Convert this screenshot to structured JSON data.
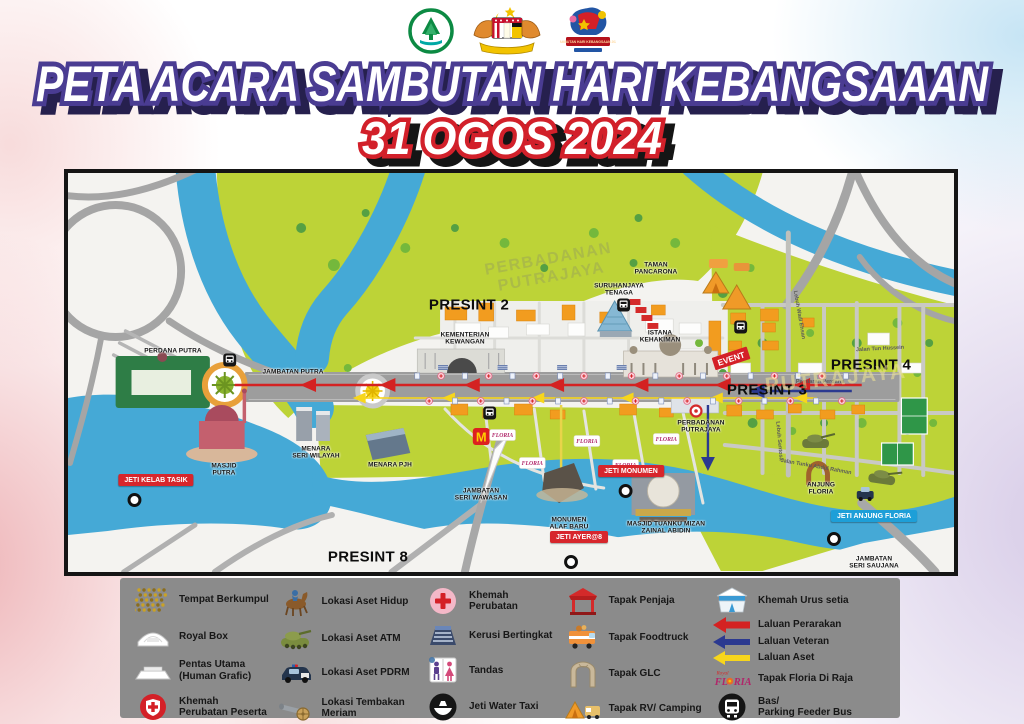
{
  "header": {
    "title": "PETA ACARA SAMBUTAN HARI KEBANGSAAAN",
    "date": "31 OGOS 2024",
    "logos": [
      {
        "name": "perbadanan-putrajaya-logo"
      },
      {
        "name": "jata-negara-malaysia-logo"
      },
      {
        "name": "sambutan-hari-kebangsaan-logo",
        "banner": "SAMBUTAN HARI KEBANGSAAN 2024"
      }
    ]
  },
  "colors": {
    "title_fill": "#ffffff",
    "title_stroke": "#4a3c92",
    "title_shadow": "#26204e",
    "date_stroke": "#d2202a",
    "date_shadow": "#151515",
    "map_green": "#bdd337",
    "map_water": "#45a9d6",
    "road_gray": "#a5a5a5",
    "legend_bg": "#8b8b8b",
    "route_parade": "#d42222",
    "route_veteran": "#2b3990",
    "route_asset": "#f7d61c",
    "badge_red": "#d7262c",
    "badge_blue": "#1d9fd8"
  },
  "map": {
    "event_flag": "EVENT",
    "floria_tag": "FLORIA",
    "mcdonalds": "M",
    "labels": [
      {
        "type": "presint",
        "text": "PRESINT 2",
        "x": 401,
        "y": 132
      },
      {
        "type": "presint",
        "text": "PRESINT 3",
        "x": 699,
        "y": 217
      },
      {
        "type": "presint",
        "text": "PRESINT 4",
        "x": 803,
        "y": 192
      },
      {
        "type": "presint",
        "text": "PRESINT 8",
        "x": 300,
        "y": 384
      },
      {
        "type": "place",
        "text": "PERDANA PUTRA",
        "x": 105,
        "y": 178
      },
      {
        "type": "place",
        "text": "KEMENTERIAN\nKEWANGAN",
        "x": 397,
        "y": 166
      },
      {
        "type": "place",
        "text": "SURUHANJAYA\nTENAGA",
        "x": 551,
        "y": 117
      },
      {
        "type": "place",
        "text": "ISTANA\nKEHAKIMAN",
        "x": 592,
        "y": 164
      },
      {
        "type": "place",
        "text": "TAMAN\nPANCARONA",
        "x": 588,
        "y": 96
      },
      {
        "type": "place",
        "text": "MASJID\nPUTRA",
        "x": 156,
        "y": 297
      },
      {
        "type": "place",
        "text": "MENARA\nSERI WILAYAH",
        "x": 248,
        "y": 280
      },
      {
        "type": "place",
        "text": "MENARA PJH",
        "x": 322,
        "y": 292
      },
      {
        "type": "place",
        "text": "JAMBATAN PUTRA",
        "x": 225,
        "y": 199
      },
      {
        "type": "place",
        "text": "JAMBATAN\nSERI WAWASAN",
        "x": 413,
        "y": 322
      },
      {
        "type": "place",
        "text": "MONUMEN\nALAF BARU",
        "x": 501,
        "y": 351
      },
      {
        "type": "place",
        "text": "MASJID TUANKU MIZAN\nZAINAL ABIDIN",
        "x": 598,
        "y": 355
      },
      {
        "type": "place",
        "text": "PERBADANAN\nPUTRAJAYA",
        "x": 633,
        "y": 254
      },
      {
        "type": "place",
        "text": "ANJUNG\nFLORIA",
        "x": 753,
        "y": 316
      },
      {
        "type": "place",
        "text": "JAMBATAN\nSERI SAUJANA",
        "x": 806,
        "y": 390
      },
      {
        "type": "badge-red",
        "text": "JETI KELAB TASIK",
        "x": 88,
        "y": 307
      },
      {
        "type": "badge-red",
        "text": "JETI MONUMEN",
        "x": 563,
        "y": 298
      },
      {
        "type": "badge-red",
        "text": "JETI AYER@8",
        "x": 511,
        "y": 364
      },
      {
        "type": "badge-blue",
        "text": "JETI ANJUNG FLORIA",
        "x": 806,
        "y": 343
      },
      {
        "type": "road",
        "text": "Jalan Tun Hussein",
        "x": 812,
        "y": 176,
        "rot": -3
      },
      {
        "type": "road",
        "text": "Persiaran Perdana",
        "x": 752,
        "y": 209,
        "rot": 0
      },
      {
        "type": "road",
        "text": "Lebuh Wadi Ehsan",
        "x": 731,
        "y": 142,
        "rot": 80
      },
      {
        "type": "road",
        "text": "Jalan Tunku Abdul Rahman",
        "x": 748,
        "y": 294,
        "rot": 10
      },
      {
        "type": "road",
        "text": "Lebuh Sentosa",
        "x": 711,
        "y": 268,
        "rot": 85
      },
      {
        "type": "watermark",
        "text": "PERBADANAN\nPUTRAJAYA",
        "x": 482,
        "y": 96,
        "rot": -10
      },
      {
        "type": "watermark2",
        "text": "PUTRAJAYA",
        "x": 768,
        "y": 206,
        "rot": -6
      }
    ]
  },
  "legend": {
    "floria_script": "Royal",
    "columns": [
      {
        "items": [
          {
            "icon": "crowd",
            "label": "Tempat Berkumpul"
          },
          {
            "icon": "royal-box",
            "label": "Royal Box"
          },
          {
            "icon": "stage",
            "label": "Pentas Utama\n(Human Grafic)"
          },
          {
            "icon": "medic-participant",
            "label": "Khemah\nPerubatan Peserta"
          }
        ]
      },
      {
        "items": [
          {
            "icon": "horse",
            "label": "Lokasi Aset Hidup"
          },
          {
            "icon": "tank",
            "label": "Lokasi Aset ATM"
          },
          {
            "icon": "police-car",
            "label": "Lokasi Aset PDRM"
          },
          {
            "icon": "cannon",
            "label": "Lokasi Tembakan\nMeriam"
          }
        ]
      },
      {
        "items": [
          {
            "icon": "medic",
            "label": "Khemah\nPerubatan"
          },
          {
            "icon": "grandstand",
            "label": "Kerusi Bertingkat"
          },
          {
            "icon": "toilet",
            "label": "Tandas"
          },
          {
            "icon": "water-taxi",
            "label": "Jeti Water Taxi"
          }
        ]
      },
      {
        "items": [
          {
            "icon": "stall",
            "label": "Tapak Penjaja"
          },
          {
            "icon": "foodtruck",
            "label": "Tapak Foodtruck"
          },
          {
            "icon": "glc",
            "label": "Tapak GLC"
          },
          {
            "icon": "camping",
            "label": "Tapak RV/ Camping"
          }
        ]
      },
      {
        "items": [
          {
            "icon": "tent-hq",
            "label": "Khemah Urus setia"
          },
          {
            "icon": "arrow-red",
            "label": "Laluan Perarakan"
          },
          {
            "icon": "arrow-blue",
            "label": "Laluan Veteran"
          },
          {
            "icon": "arrow-yellow",
            "label": "Laluan Aset"
          },
          {
            "icon": "floria",
            "label": "Tapak Floria Di Raja"
          },
          {
            "icon": "bus",
            "label": "Bas/\nParking Feeder Bus"
          }
        ]
      }
    ]
  }
}
